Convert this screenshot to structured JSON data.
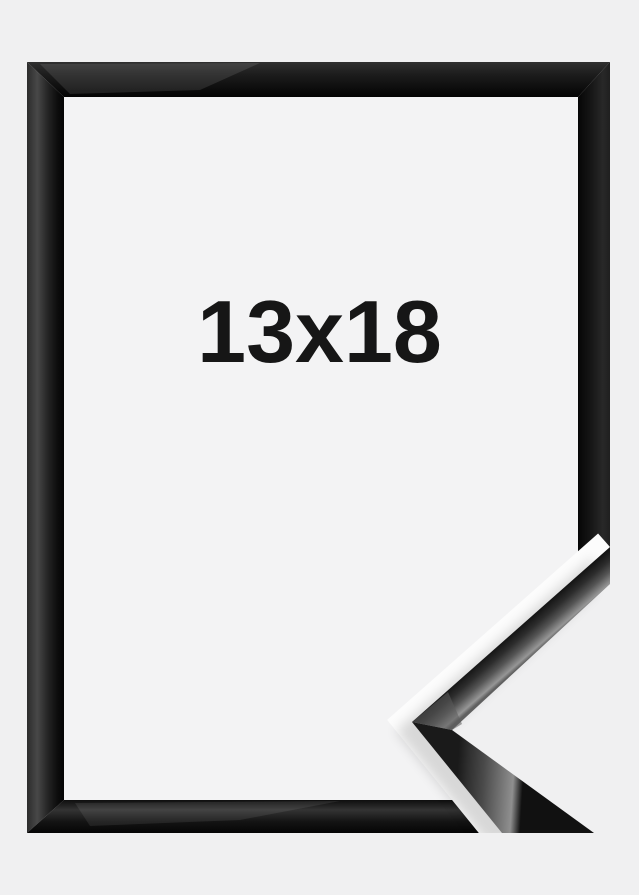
{
  "product_photo": {
    "size_label": "13x18",
    "frame_finish": "glossy black",
    "colors": {
      "background": "#f0f0f1",
      "frame_interior": "#f3f3f4",
      "cutout_halo": "#fcfcfc",
      "frame_black": "#111111",
      "frame_highlight": "#8f8f8f",
      "label_text": "#161616"
    }
  }
}
